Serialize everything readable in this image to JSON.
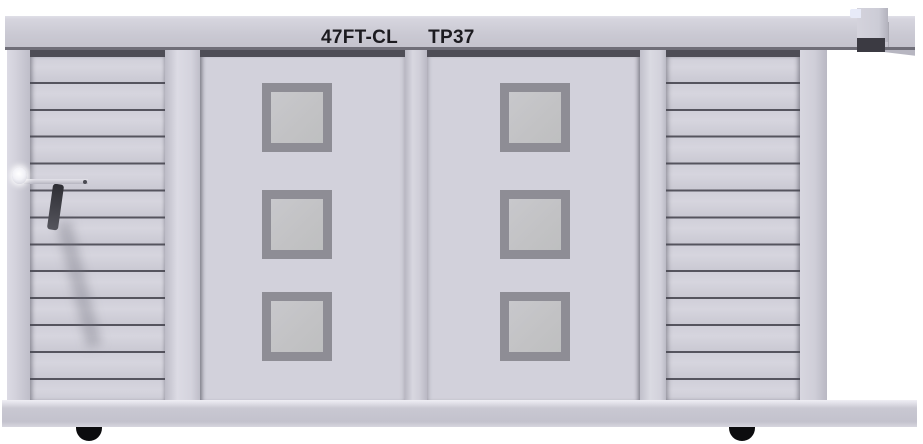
{
  "header": {
    "model_label": "47FT-CL",
    "code_label": "TP37"
  },
  "unit": {
    "door_count": 2,
    "windows_per_door": 3,
    "slat_lines_left_panel": 12,
    "slat_lines_right_panel": 12,
    "wheel_count": 2
  },
  "colors": {
    "background": "#ffffff",
    "rail_face": "#cac9d3",
    "rail_bottom_edge": "#6f6e78",
    "recess_shadow": "#4e4d56",
    "door_panel": "#d2d1db",
    "slat_panel": "#d0cfd9",
    "slat_line": "#55545e",
    "window_frame": "#8e8d95",
    "window_glass": "#c3c3c6",
    "base_rail": "#c9c8d2",
    "wheel": "#0c0c0e",
    "label_text": "#1c1b20",
    "bracket_shadow": "#3b3a42"
  }
}
